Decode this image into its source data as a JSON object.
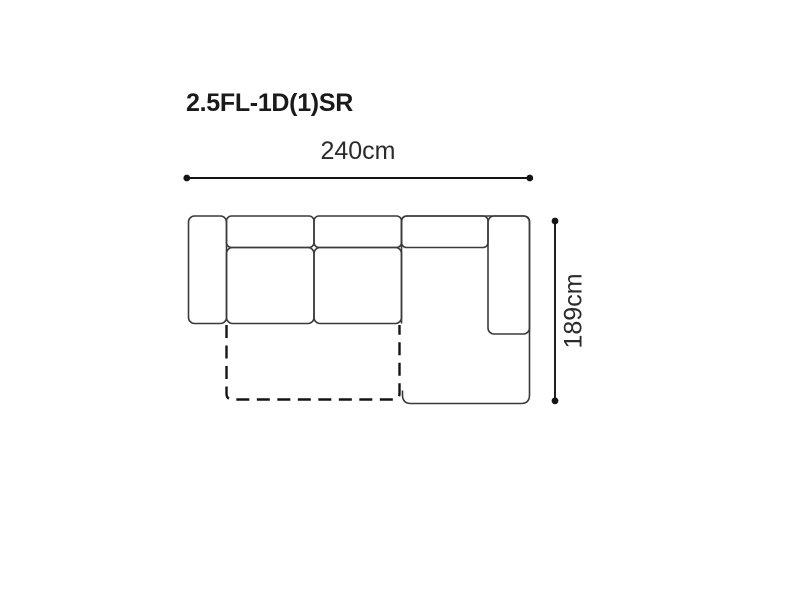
{
  "diagram": {
    "title": "2.5FL-1D(1)SR",
    "width_label": "240cm",
    "depth_label": "189cm"
  },
  "colors": {
    "background": "#ffffff",
    "title_text": "#1a1a1a",
    "dimension_text": "#2b2b2b",
    "dimension_line": "#141414",
    "sofa_outline": "#3a3a3a",
    "dashed_outline": "#141414"
  }
}
